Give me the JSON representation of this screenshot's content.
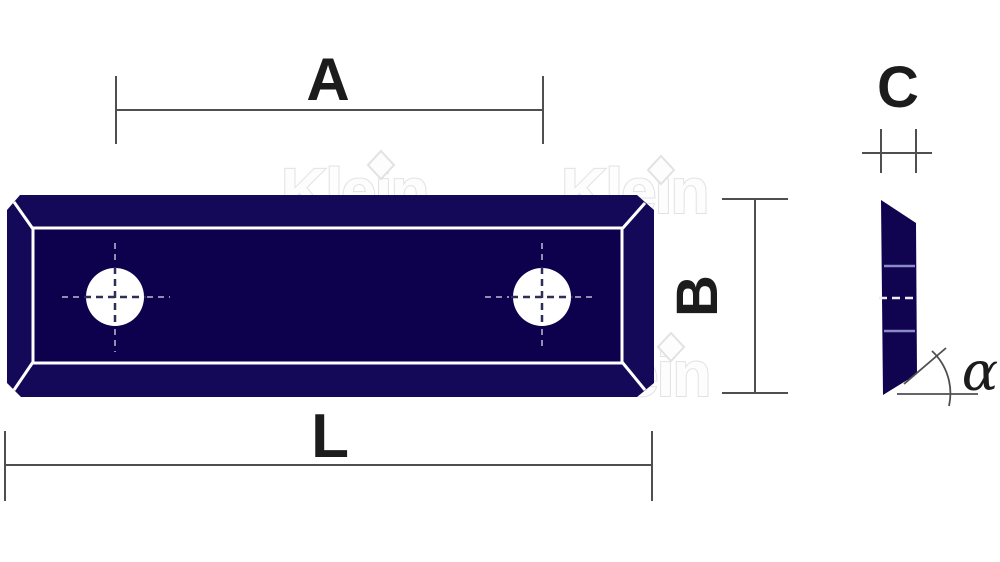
{
  "dimensions": {
    "a": "A",
    "b": "B",
    "c": "C",
    "l": "L",
    "alpha": "α"
  },
  "watermark": {
    "text": "Klein"
  },
  "colors": {
    "plate_bevel_navy": "#140959",
    "plate_face_navy": "#0d014e",
    "side_profile_navy": "#10034f",
    "dimension_line_gray": "#4f4f4f",
    "label_black": "#1c1c1c",
    "watermark_gray": "#e2e2e2",
    "centerline_light": "#8f8fb4",
    "centerline_dark": "#2e2e58",
    "side_groove_lavender": "#8a8ac8"
  }
}
